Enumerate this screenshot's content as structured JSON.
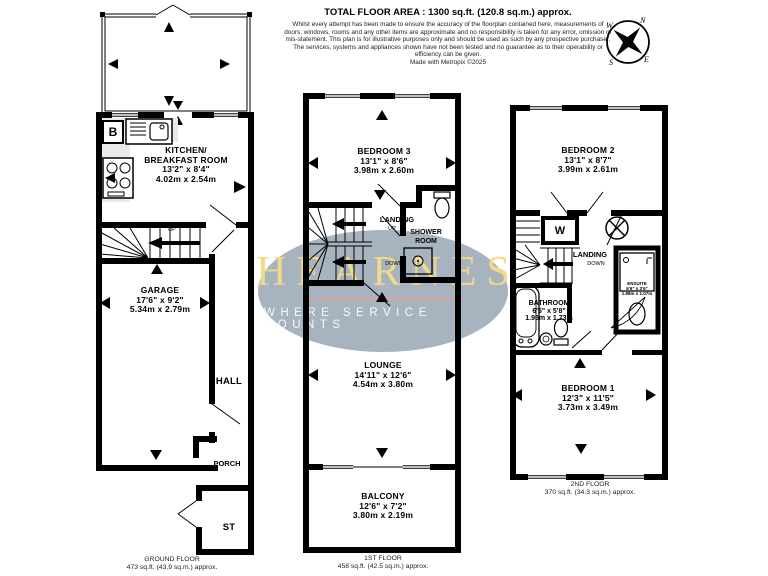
{
  "header": {
    "title": "TOTAL FLOOR AREA : 1300 sq.ft. (120.8 sq.m.) approx.",
    "disclaimer": "Whilst every attempt has been made to ensure the accuracy of the floorplan contained here, measurements of doors, windows, rooms and any other items are approximate and no responsibility is taken for any error, omission or mis-statement. This plan is for illustrative purposes only and should be used as such by any prospective purchaser. The services, systems and appliances shown have not been tested and no guarantee as to their operability or efficiency can be given.",
    "credit": "Made with Metropix ©2025"
  },
  "compass": {
    "north": "N",
    "east": "E",
    "south": "S",
    "west": "W"
  },
  "watermark": {
    "brand": "HEARNES",
    "tagline": "WHERE SERVICE COUNTS"
  },
  "ground_floor": {
    "label": "GROUND FLOOR",
    "area": "473 sq.ft. (43.9 sq.m.) approx.",
    "kitchen": {
      "line1": "KITCHEN/",
      "line2": "BREAKFAST ROOM",
      "imperial": "13'2\" x 8'4\"",
      "metric": "4.02m x 2.54m"
    },
    "garage": {
      "name": "GARAGE",
      "imperial": "17'6\" x 9'2\"",
      "metric": "5.34m x 2.79m"
    },
    "hall": "HALL",
    "porch": "PORCH",
    "store": "ST",
    "boiler": "B",
    "up": "UP"
  },
  "first_floor": {
    "label": "1ST FLOOR",
    "area": "458 sq.ft. (42.5 sq.m.) approx.",
    "bedroom3": {
      "name": "BEDROOM 3",
      "imperial": "13'1\" x 8'6\"",
      "metric": "3.98m x 2.60m"
    },
    "landing": "LANDING",
    "up": "UP",
    "down": "DOWN",
    "shower_room": {
      "line1": "SHOWER",
      "line2": "ROOM"
    },
    "lounge": {
      "name": "LOUNGE",
      "imperial": "14'11\" x 12'6\"",
      "metric": "4.54m x 3.80m"
    },
    "balcony": {
      "name": "BALCONY",
      "imperial": "12'6\" x 7'2\"",
      "metric": "3.80m x 2.19m"
    }
  },
  "second_floor": {
    "label": "2ND FLOOR",
    "area": "370 sq.ft. (34.3 sq.m.) approx.",
    "bedroom2": {
      "name": "BEDROOM 2",
      "imperial": "13'1\" x 8'7\"",
      "metric": "3.99m x 2.61m"
    },
    "wardrobe": "W",
    "landing": "LANDING",
    "down": "DOWN",
    "bathroom": {
      "name": "BATHROOM",
      "imperial": "6'5\" x 5'8\"",
      "metric": "1.95m x 1.73m"
    },
    "ensuite": {
      "name": "ENSUITE",
      "imperial": "6'6\" x 3'6\"",
      "metric": "1.98m x 1.07m"
    },
    "bedroom1": {
      "name": "BEDROOM 1",
      "imperial": "12'3\" x 11'5\"",
      "metric": "3.73m x 3.49m"
    }
  },
  "colors": {
    "wall": "#000000",
    "worktop": "#e9e9e9",
    "ellipse": "#98a6b4",
    "brand_gold": "#f1d987",
    "underline_pink": "#dba39e"
  }
}
